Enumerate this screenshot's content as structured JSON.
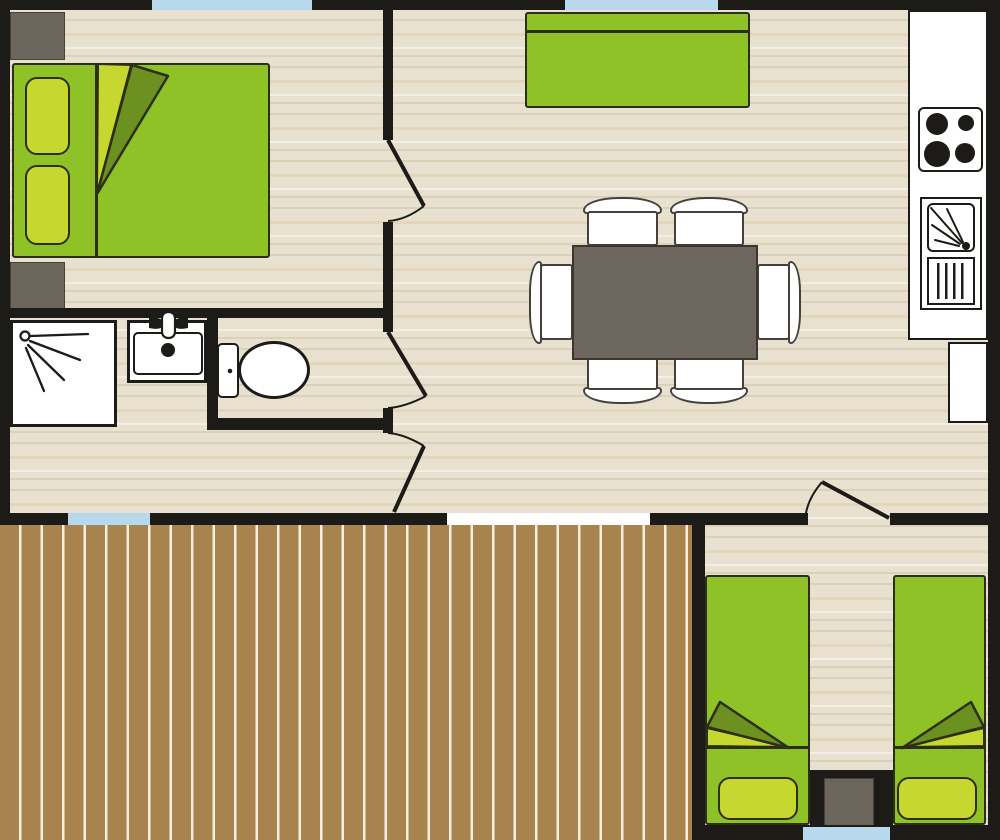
{
  "meta": {
    "type": "floor-plan",
    "subject": "mobile-home / bungalow layout with decked terrace",
    "scale_px": {
      "width": 1000,
      "height": 840
    }
  },
  "colors": {
    "wall": "#1d1b17",
    "floor": "#e9e1cf",
    "terrace": "#a8834e",
    "terrace-stripe": "#f3eee0",
    "window": "#b8d9ed",
    "green": "#8ec226",
    "green-light": "#c6d72f",
    "green-dark": "#6d9120",
    "outline": "#2c2f16",
    "gray": "#6b655c",
    "table": "#6e675f",
    "chair": "#45413a",
    "white": "#ffffff"
  },
  "rooms": {
    "bedroom_master": {
      "position": "top-left",
      "furniture": [
        "double-bed",
        "pillow",
        "pillow",
        "folded-blanket",
        "nightstand",
        "nightstand"
      ],
      "windows": 1,
      "doors": 1
    },
    "living_dining": {
      "position": "top-center",
      "furniture": [
        "sofa",
        "dining-table",
        "chair",
        "chair",
        "chair",
        "chair",
        "chair",
        "chair"
      ],
      "windows": 1,
      "doors": 0
    },
    "kitchen": {
      "position": "right-strip",
      "furniture": [
        "counter",
        "hob-4-burners",
        "sink",
        "drainboard",
        "tall-unit"
      ]
    },
    "bathroom": {
      "position": "mid-left",
      "furniture": [
        "shower-tray",
        "washbasin-vanity"
      ],
      "windows": 1,
      "doors": 1
    },
    "wc": {
      "position": "mid-center-left",
      "furniture": [
        "toilet"
      ],
      "doors": 1
    },
    "bedroom_twin": {
      "position": "bottom-right",
      "furniture": [
        "single-bed",
        "single-bed",
        "folded-blanket",
        "folded-blanket",
        "nightstand"
      ],
      "windows": 1,
      "doors": 1
    },
    "terrace": {
      "position": "bottom-left",
      "furniture": [
        "wood-decking"
      ]
    }
  },
  "counts": {
    "windows": 4,
    "door-swings": 4,
    "chairs": 6,
    "beds": 3,
    "hob_burners": 4
  }
}
